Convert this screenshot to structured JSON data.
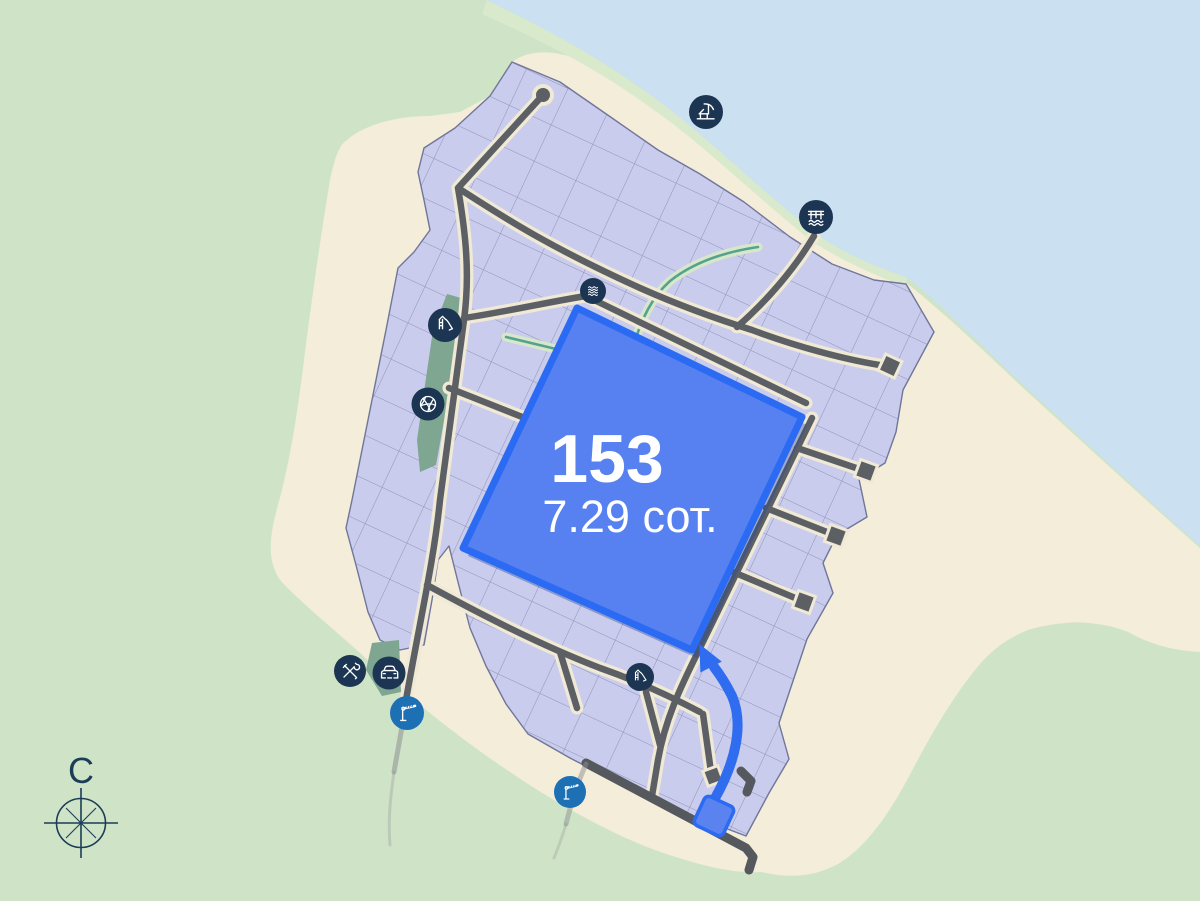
{
  "map": {
    "title": "land-plot-masterplan-map",
    "highlighted_plot": {
      "number": "153",
      "area": "7.29 сот."
    },
    "compass": {
      "north_label": "С"
    },
    "amenity_icons": [
      {
        "name": "beach-lounger-icon"
      },
      {
        "name": "pier-icon"
      },
      {
        "name": "waves-icon"
      },
      {
        "name": "playground-slide-icon"
      },
      {
        "name": "basketball-icon"
      },
      {
        "name": "tools-icon"
      },
      {
        "name": "car-icon"
      },
      {
        "name": "barrier-gate-icon"
      },
      {
        "name": "playground-slide-icon-south"
      },
      {
        "name": "barrier-gate-icon-south"
      }
    ],
    "colors": {
      "highlight_fill": "#5781f0",
      "highlight_border": "#2b6bf3",
      "route_arrow": "#2f6cf0",
      "badge_navy": "#1c3553",
      "badge_blue": "#1e70b5",
      "water": "#cbe0f0",
      "sand": "#f3edd9",
      "grass": "#cfe4c7",
      "parcel": "#c9ccec",
      "road": "#5c6064",
      "road_casing": "#efe9d5",
      "park_green": "#7fa690"
    }
  }
}
